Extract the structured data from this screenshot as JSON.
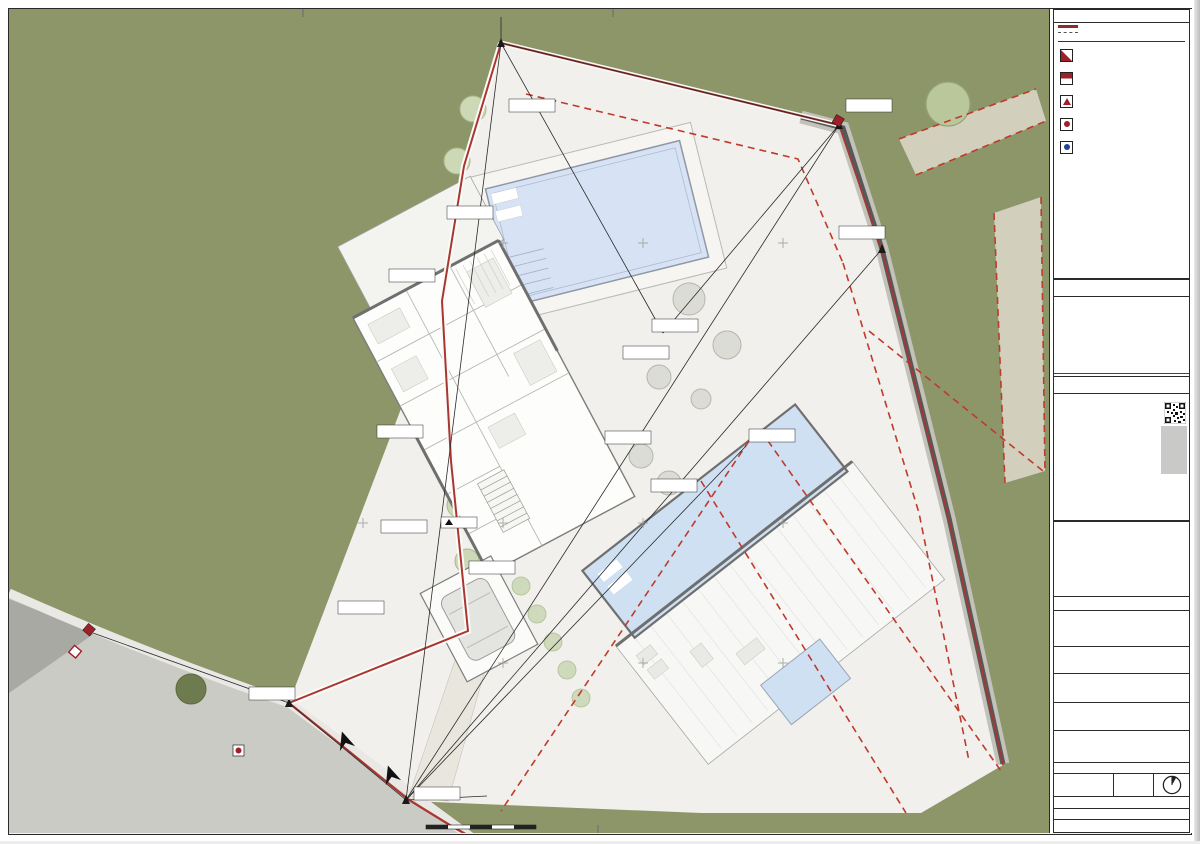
{
  "map": {
    "grid_labels": [
      "297435",
      "297445",
      "297455",
      "297465",
      "297475",
      "297485",
      "4022215",
      "4022200",
      "4022180",
      "4022215",
      "4022200",
      "4022180",
      "297445",
      "297455",
      "297465",
      "297475",
      "297485",
      "4022170",
      "297445",
      "297455",
      "297465",
      "297475",
      "297485",
      "4022160",
      "4022160"
    ],
    "survey_points": [
      [
        "N: 4022214.29",
        "E: 297454.86"
      ],
      [
        "N: 4022208.43",
        "E: 297479.00"
      ],
      [
        "N: 4022199.57",
        "E: 297482.07"
      ],
      [
        "N: 4022195.86",
        "E: 297450.64"
      ],
      [
        "N: 4022193.36",
        "E: 297466.29"
      ],
      [
        "N: 4022191.57",
        "E: 297464.14"
      ],
      [
        "N: 4022185.50",
        "E: 297462.71"
      ],
      [
        "N: 4022186.21",
        "E: 297447.00"
      ],
      [
        "N: 4022182.29",
        "E: 297465.93"
      ],
      [
        "N: 4022179.43",
        "E: 297447.00"
      ],
      [
        "N: 4022176.43",
        "E: 297453.07"
      ],
      [
        "N: 4022173.57",
        "E: 297443.79"
      ],
      [
        "N: 4022167.14",
        "E: 297439.71"
      ],
      [
        "N: 4022160.21",
        "E: 297448.07"
      ],
      [
        "N: 4022185.50",
        "E: 297472.36"
      ],
      [
        "N: 4022202.29",
        "E: 297451.43"
      ]
    ],
    "dimensions": [
      "23.98",
      "36.42",
      "53.62",
      "31.25",
      "11.06",
      "14.41",
      "9.42"
    ],
    "access": {
      "r1": "Acceso",
      "r2": "rodado",
      "p1": "Acceso",
      "p2": "peatonal"
    },
    "elevation": "+92.30",
    "scalebar_label": "Escala 1:200"
  },
  "titleblock": {
    "top_label": "LEYENDA:",
    "legend": {
      "line1": "Línea de parcela",
      "line2": "Línea de separación a linderos",
      "infra_heading": "Leyenda Infraestructuras",
      "items": [
        "Arqueta acometida eléctrica",
        "Arqueta de telefonía",
        "Arqueta abastecimiento agua potable",
        "Pozo acometida fecales",
        "Pozo acometida pluviales"
      ]
    },
    "ref_catastral": "REF. CATASTRAL: 7624509TF9272S0000RP",
    "modificaciones": {
      "heading": "MODIFICACIÓN(ES):",
      "row": {
        "revision": "Subsanación A/A.",
        "fecha": "17/05/2024",
        "verificado": "ISH",
        "id": "A"
      },
      "headers": {
        "revision": "Revisión:",
        "fecha": "Fecha:",
        "verificado": "Verificado:",
        "id": "ID"
      }
    },
    "stage": "ANTEPROYECTO",
    "notes_heading": "NOTAS GENERALES:",
    "notes": "- EL PRESENTE DOCUMENTO ES COPIA DE EL ORIGINAL DEL QUE ES AUTOR LA SOCIEDAD HUETE ARQUITECTOS, S.L.P. CON SU ENTREGA NO SE CEDEN LOS DOCUMENTOS DE PLANEAMIENTO. LA UTILIZACIÓN TOTAL O PARCIAL, ASÍ COMO CUALQUIER REPRODUCCIÓN O CESIÓN A TERCEROS, REQUERIRÁ LA PREVIA AUTORIZACIÓN EXPRESA Y FEHACIENTE DE SU AUTORA, QUEDANDO EN CUALQUIER CASO PROHIBIDA CUALQUIER MODIFICACIÓN UNILATERAL DEL MISMO.\n- NO ESCALAR SOBRE EL DIBUJO.\n- CUALQUIER ERROR DETECTADO DEBE SER PUESTO EN CONOCIMIENTO DEL ARQUITECTO REDACTOR PARA SU SUBSANACIÓN.\n- EL DOCUMENTO DEBE LEERSE EN CONJUNTO CON TODOS LOS PROYECTOS QUE ESTÁN PARTICIPANDO EN EL PROYECTO.\n- TODAS LAS PREINSTALACIONES (ACOMETIDAS, LUMINARIAS, REGISTROS, MOBILIARIO, ...) Y SUS CARACTERÍSTICAS DEBERÁN SER COMPROBADAS Y CONTRASTADAS EN EL SITIO ANTES DEL INICIO DE LOS TRABAJOS PERTINENTES.\n- ESTE PROYECTO, EN SU COMPLETA DEFINICIÓN, SÓLO SERÁ VÁLIDO CON LA APROBACIÓN DEFINITIVA ENTRE EL PROMOTOR Y LA DIRECCIÓN FACULTATIVA.\n- EN CASO DE INFORMACIÓN DISCREPANTE O NO COMPATIBLE ENTRE LOS DOCUMENTOS QUE LO CONFORMAN, EL ORDEN DE PREVALENCIA ES EL SIGUIENTE: PLANOS SOBRE MEMORIAS, MEMORIAS SOBRE MEDICIONES Y ÉSTAS SOBRE EL PLIEGO.",
    "firm": {
      "logo_text": "uete",
      "logo_h": "h",
      "logo_sub": "Arquitectos",
      "name": "HUETE ARQUITECTOS, S.L.P.",
      "colegiada": "SOCIEDAD COLEGIADA Nº 417 COA MÁLAGA",
      "partner1_name": "D. FRANCISCO LÓPEZ HUETE",
      "partner1_col": "Nº Colegiado 417 COA Málaga",
      "partner2_name": "D. GUSTAVO A. LÓPEZ HUETE",
      "partner2_col": "Nº Colegiado 618 COA Málaga",
      "office1_city": "SEVILLA",
      "office1_addr": "CALLE GENIL, 54",
      "office1_tel": "T 955 09 79 50",
      "office2_city": "ESTEPONA - MARBELLA - MÁLAGA",
      "office2_addr": "URB. EL SALADILLO | EDIFICIO ALTAIR, 105.",
      "office2_tel": "T 952 79 49 50",
      "web": "www.huetearquitectos.com",
      "email": "info@huetearquitectos.com"
    },
    "promotor_label": "PROMOTOR:",
    "promotor": "VID GLOBAL BUILDINGS 2018, SL",
    "titulo_label": "TÍTULO DEL PROYECTO:",
    "titulo": "VIVIENDA UNIFAMILIAR AISLADA",
    "situacion_label": "SITUACIÓN:",
    "situacion1": "Arrabal Calataraja 28, Parcela 3",
    "situacion2": "29692 MANILVA, MÁLAGA.",
    "plano_label": "PLANO DE:",
    "plano": "TOPOGRÁFICO MODIFICADO, URBANIZACIÓN Y DATOS URBANÍSTICOS",
    "subplano": "02.EMPLAZAMIENTO Y JUSTIFICACIÓN URBANÍSTICA",
    "code": "7-EMP01",
    "escala_label": "ESCALA:",
    "escala1": "1:200(A1)",
    "escala2": "1:400(A3)",
    "fecha_label": "FECHA:",
    "fecha": "NOVIEMBRE 2024",
    "control_label": "DATOS DE CONTROL:",
    "control_dibujado": "DIBUJADO(INICIALES):",
    "control_dibujado_val": "MA/JSO",
    "control_revisado": "REVISADO:",
    "control_revisado_val": "ISH",
    "codigo_label": "CÓDIGO DE PROYECTO:",
    "codigo": "2301_MANILVA-EMP01-General-2301_HUE_PL_PROYT.rvt"
  }
}
